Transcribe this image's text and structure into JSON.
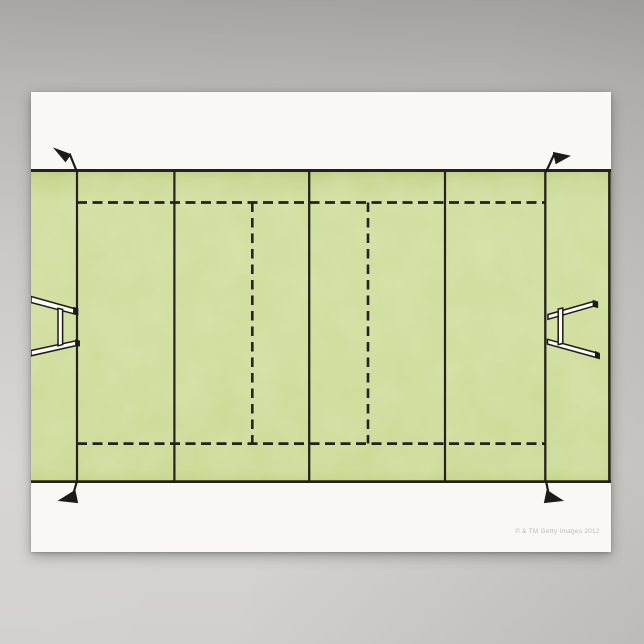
{
  "scene": {
    "type": "poster-product-photo",
    "subject": "Watercolor illustration of a rugby pitch seen from above"
  },
  "colors": {
    "background_top": "#a2a19d",
    "background_bottom": "#d1d0cc",
    "poster_paper": "#f9f8f5",
    "grass": "#cedd9b",
    "grass_dark_edge": "#b7c97f",
    "line_ink": "#23221c",
    "goalpost_fill": "#fcfbf7",
    "watermark": "#bcbbb8"
  },
  "field": {
    "solid_lines": [
      "top-touchline",
      "bottom-touchline",
      "right-dead-ball-line",
      "left-goal-line",
      "left-22-metre-line",
      "halfway-line",
      "right-22-metre-line",
      "right-goal-line"
    ],
    "dashed_lines": [
      "upper-dashed-line",
      "lower-dashed-line",
      "left-10-metre-line",
      "right-10-metre-line"
    ],
    "corner_flags": 4,
    "goalposts": 2
  },
  "watermark": {
    "text": "© & TM Getty Images 2012"
  }
}
